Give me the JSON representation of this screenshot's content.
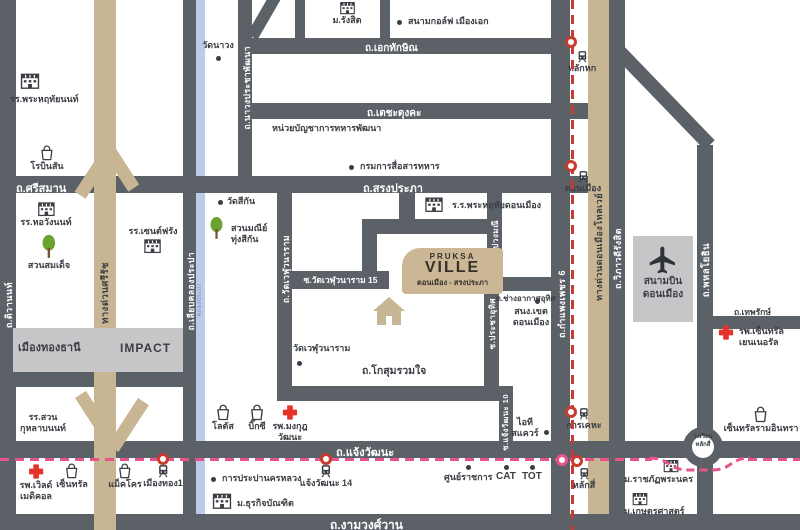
{
  "project": {
    "brand": "PRUKSA",
    "name": "VILLE",
    "subtitle": "ดอนเมือง - สรงประภา"
  },
  "roads": {
    "tiwanon": "ถ.ติวานนท์",
    "liap_khlong_prapa": "ถ.เลียบคลองประปา",
    "khlong_prapa": "คลองประปา",
    "nawong_prachaphatthana": "ถ.นาวงประชาพัฒนา",
    "ek_thaksin": "ถ.เอกทักษิณ",
    "techa_tungka": "ถ.เตชะตุงคะ",
    "si_saman": "ถ.ศรีสมาน",
    "song_prapha": "ถ.สรงประภา",
    "si_rat_expressway": "ทางด่วนศรีรัช",
    "wat_weluwanaram": "ถ.วัดเวฬุวนาราม",
    "soi_wat_weluwanaram_15": "ซ.วัดเวฬุวนาราม 15",
    "kosum_ruamchai": "ถ.โกสุมรวมใจ",
    "soi_buang_mani": "ซ.บ่วงมณี",
    "chang_arkat_uthit": "ถ.ช่างอากาศอุทิศ",
    "soi_pracha_uthit": "ซ.ประชาอุทิศ",
    "soi_chaengwattana_10": "ซ.แจ้งวัฒนะ 10",
    "kamphaeng_phet_6": "ถ.กำแพงเพชร 6",
    "don_mueang_tollway": "ทางด่วนดอนเมืองโทลเวย์",
    "vibhavadi_rangsit": "ถ.วิภาวดีรังสิต",
    "phahonyothin": "ถ.พหลโยธิน",
    "thepharak": "ถ.เทพรักษ์",
    "chaengwattana": "ถ.แจ้งวัฒนะ",
    "ngamwongwan": "ถ.งามวงศ์วาน"
  },
  "landmarks": {
    "phrahruethai_non": "รร.พระหฤทัยนนท์",
    "robinson": "โรบินสัน",
    "wat_nawong": "วัดนาวง",
    "rangsit_university": "ม.รังสิต",
    "golf_muang_ek": "สนามกอล์ฟ เมืองเอก",
    "military_dev_command": "หน่วยบัญชาการทหารพัฒนา",
    "signal_department": "กรมการสื่อสารทหาร",
    "horwang_non": "รร.หอวังนนท์",
    "suan_somdet": "สวนสมเด็จ",
    "saint_francis": "รร.เซนต์ฟรัง",
    "wat_sikan": "วัดสีกัน",
    "suan_mani_thung_sikan": "สวนมณีย์\nทุ่งสีกัน",
    "muang_thong_thani": "เมืองทองธานี",
    "impact": "IMPACT",
    "phrahruethai_don_mueang": "ร.ร.พระหฤทัยดอนเมือง",
    "wat_weluwanaram_temple": "วัดเวฬุวนาราม",
    "district_office": "สนง.เขต\nดอนเมือง",
    "it_square": "ไอที\nสแควร์",
    "suan_kulap_non": "รร.สวน\nกุหลาบนนท์",
    "world_medical": "รพ.เวิลด์\nเมดิคอล",
    "central": "เซ็นทรัล",
    "makro": "แม็คโคร",
    "lotus": "โลตัส",
    "big_c": "บิ๊กซี",
    "mongkut_wattana": "รพ.มงกุฎ\nวัฒนะ",
    "waterworks": "การประปานครหลวง",
    "dhurakij_bundit": "ม.ธุรกิจบัณฑิต",
    "gov_center": "ศูนย์ราชการ",
    "cat": "CAT",
    "tot": "TOT",
    "airport": "สนามบิน\nดอนเมือง",
    "central_general": "รพ.เซ็นทรัล\nเยนเนอรัล",
    "central_ramintra": "เซ็นทรัลรามอินทรา",
    "rajabhat_phranakhon": "ม.ราชภัฏพระนคร",
    "kasetsart": "ม.เกษตรศาสตร์",
    "roundabout_laksi": "วงเวียน\nหลักสี่"
  },
  "stations": {
    "lak_hok": "หลักหก",
    "don_mueang": "ดอนเมือง",
    "kan_kheha": "การเคหะ",
    "lak_si": "หลักสี่",
    "muang_thong_1": "เมืองทอง1",
    "chaengwattana_14": "แจ้งวัฒนะ 14"
  },
  "colors": {
    "road": "#5c6167",
    "expressway_tan": "#c8b593",
    "canal_blue": "#bccbe8",
    "light_area": "#c6c6c8",
    "landmark_text": "#3b3e44",
    "hospital_red": "#e6332a",
    "tree_green": "#6aa32f",
    "red_line": "#c63c30",
    "pink_line": "#e8538a"
  }
}
